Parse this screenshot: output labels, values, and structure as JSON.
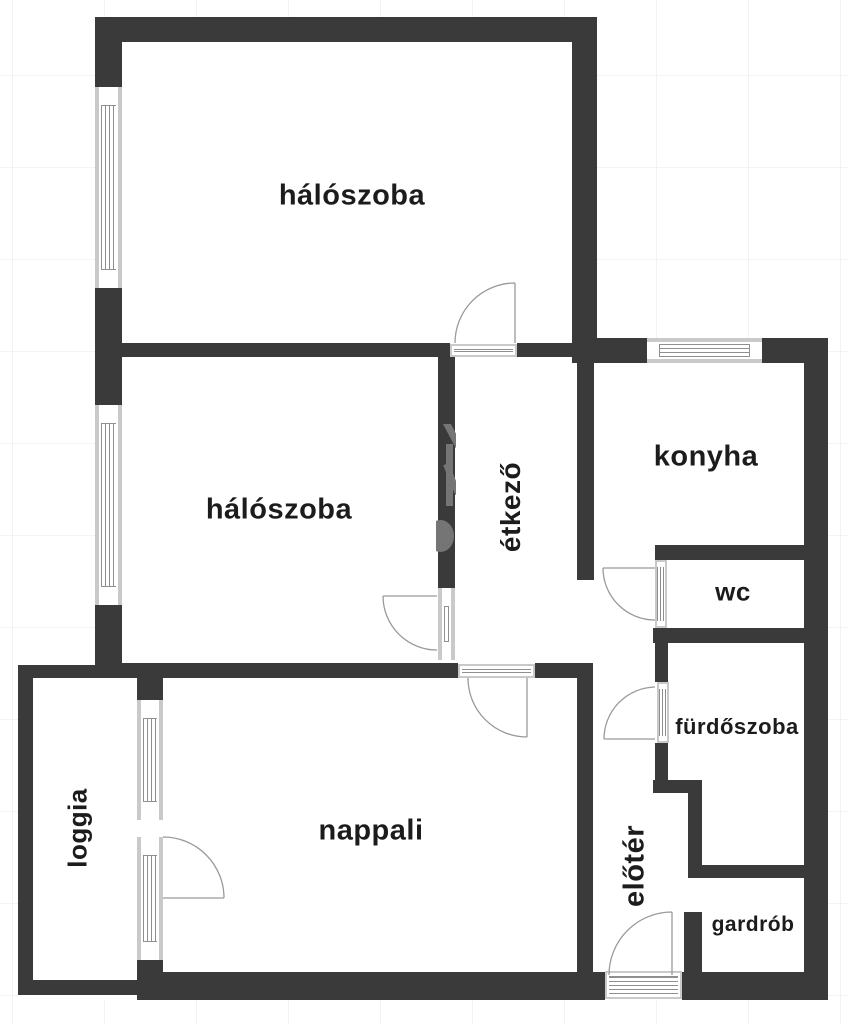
{
  "plan": {
    "title": "apartment floor plan",
    "rooms": [
      {
        "id": "haloszoba-top",
        "label": "hálószoba"
      },
      {
        "id": "haloszoba-mid",
        "label": "hálószoba"
      },
      {
        "id": "etkezo",
        "label": "étkező"
      },
      {
        "id": "konyha",
        "label": "konyha"
      },
      {
        "id": "wc",
        "label": "wc"
      },
      {
        "id": "furdoszoba",
        "label": "fürdőszoba"
      },
      {
        "id": "nappali",
        "label": "nappali"
      },
      {
        "id": "loggia",
        "label": "loggia"
      },
      {
        "id": "eloter",
        "label": "előtér"
      },
      {
        "id": "gardrob",
        "label": "gardrób"
      }
    ],
    "colors": {
      "wall": "#3a3a3a",
      "window_frame": "#c9c9c9",
      "window_line": "#8f8f8f",
      "door_line": "#9a9a9a",
      "label": "#1c1c1c",
      "grid": "#f3f3f3",
      "room_fill": "#ffffff"
    }
  }
}
